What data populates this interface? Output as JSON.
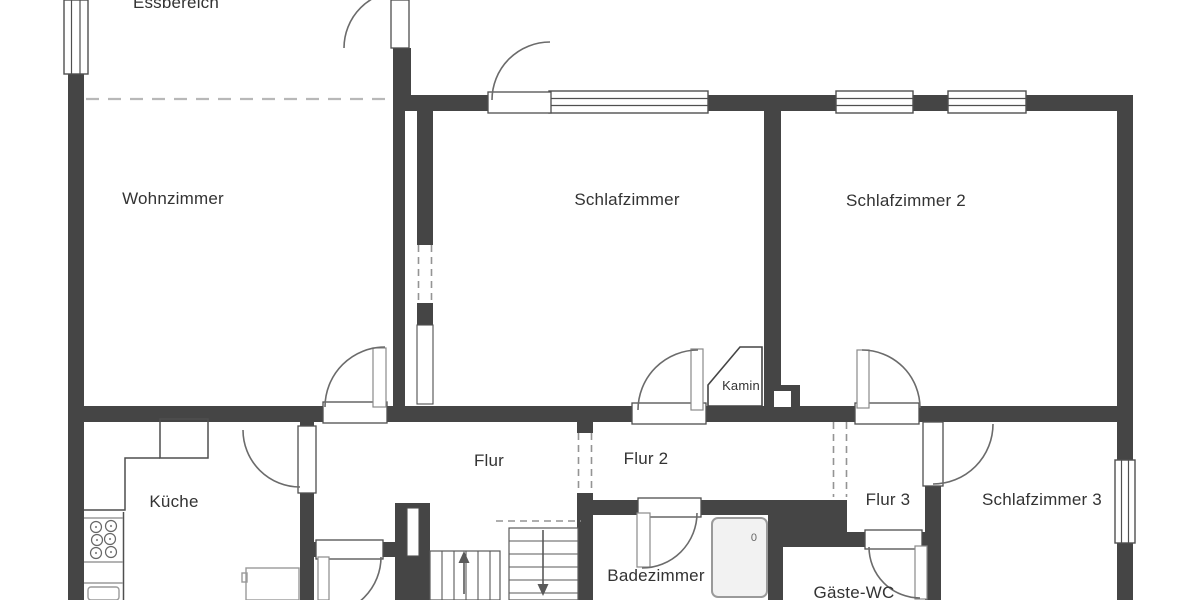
{
  "floorplan": {
    "rooms": {
      "essbereich": {
        "label": "Essbereich"
      },
      "wohnzimmer": {
        "label": "Wohnzimmer"
      },
      "schlafzimmer": {
        "label": "Schlafzimmer"
      },
      "schlafzimmer2": {
        "label": "Schlafzimmer 2"
      },
      "schlafzimmer3": {
        "label": "Schlafzimmer 3"
      },
      "kueche": {
        "label": "Küche"
      },
      "flur": {
        "label": "Flur"
      },
      "flur2": {
        "label": "Flur 2"
      },
      "flur3": {
        "label": "Flur 3"
      },
      "badezimmer": {
        "label": "Badezimmer"
      },
      "gaeste_wc": {
        "label": "Gäste-WC"
      },
      "kamin": {
        "label": "Kamin"
      }
    },
    "symbols": {
      "shower_mark": "0"
    },
    "colors": {
      "wall": "#454545",
      "line": "#4f4f4f",
      "dash": "#949494",
      "text": "#333333",
      "fixture": "#f2f2f2",
      "bg": "#ffffff"
    }
  }
}
